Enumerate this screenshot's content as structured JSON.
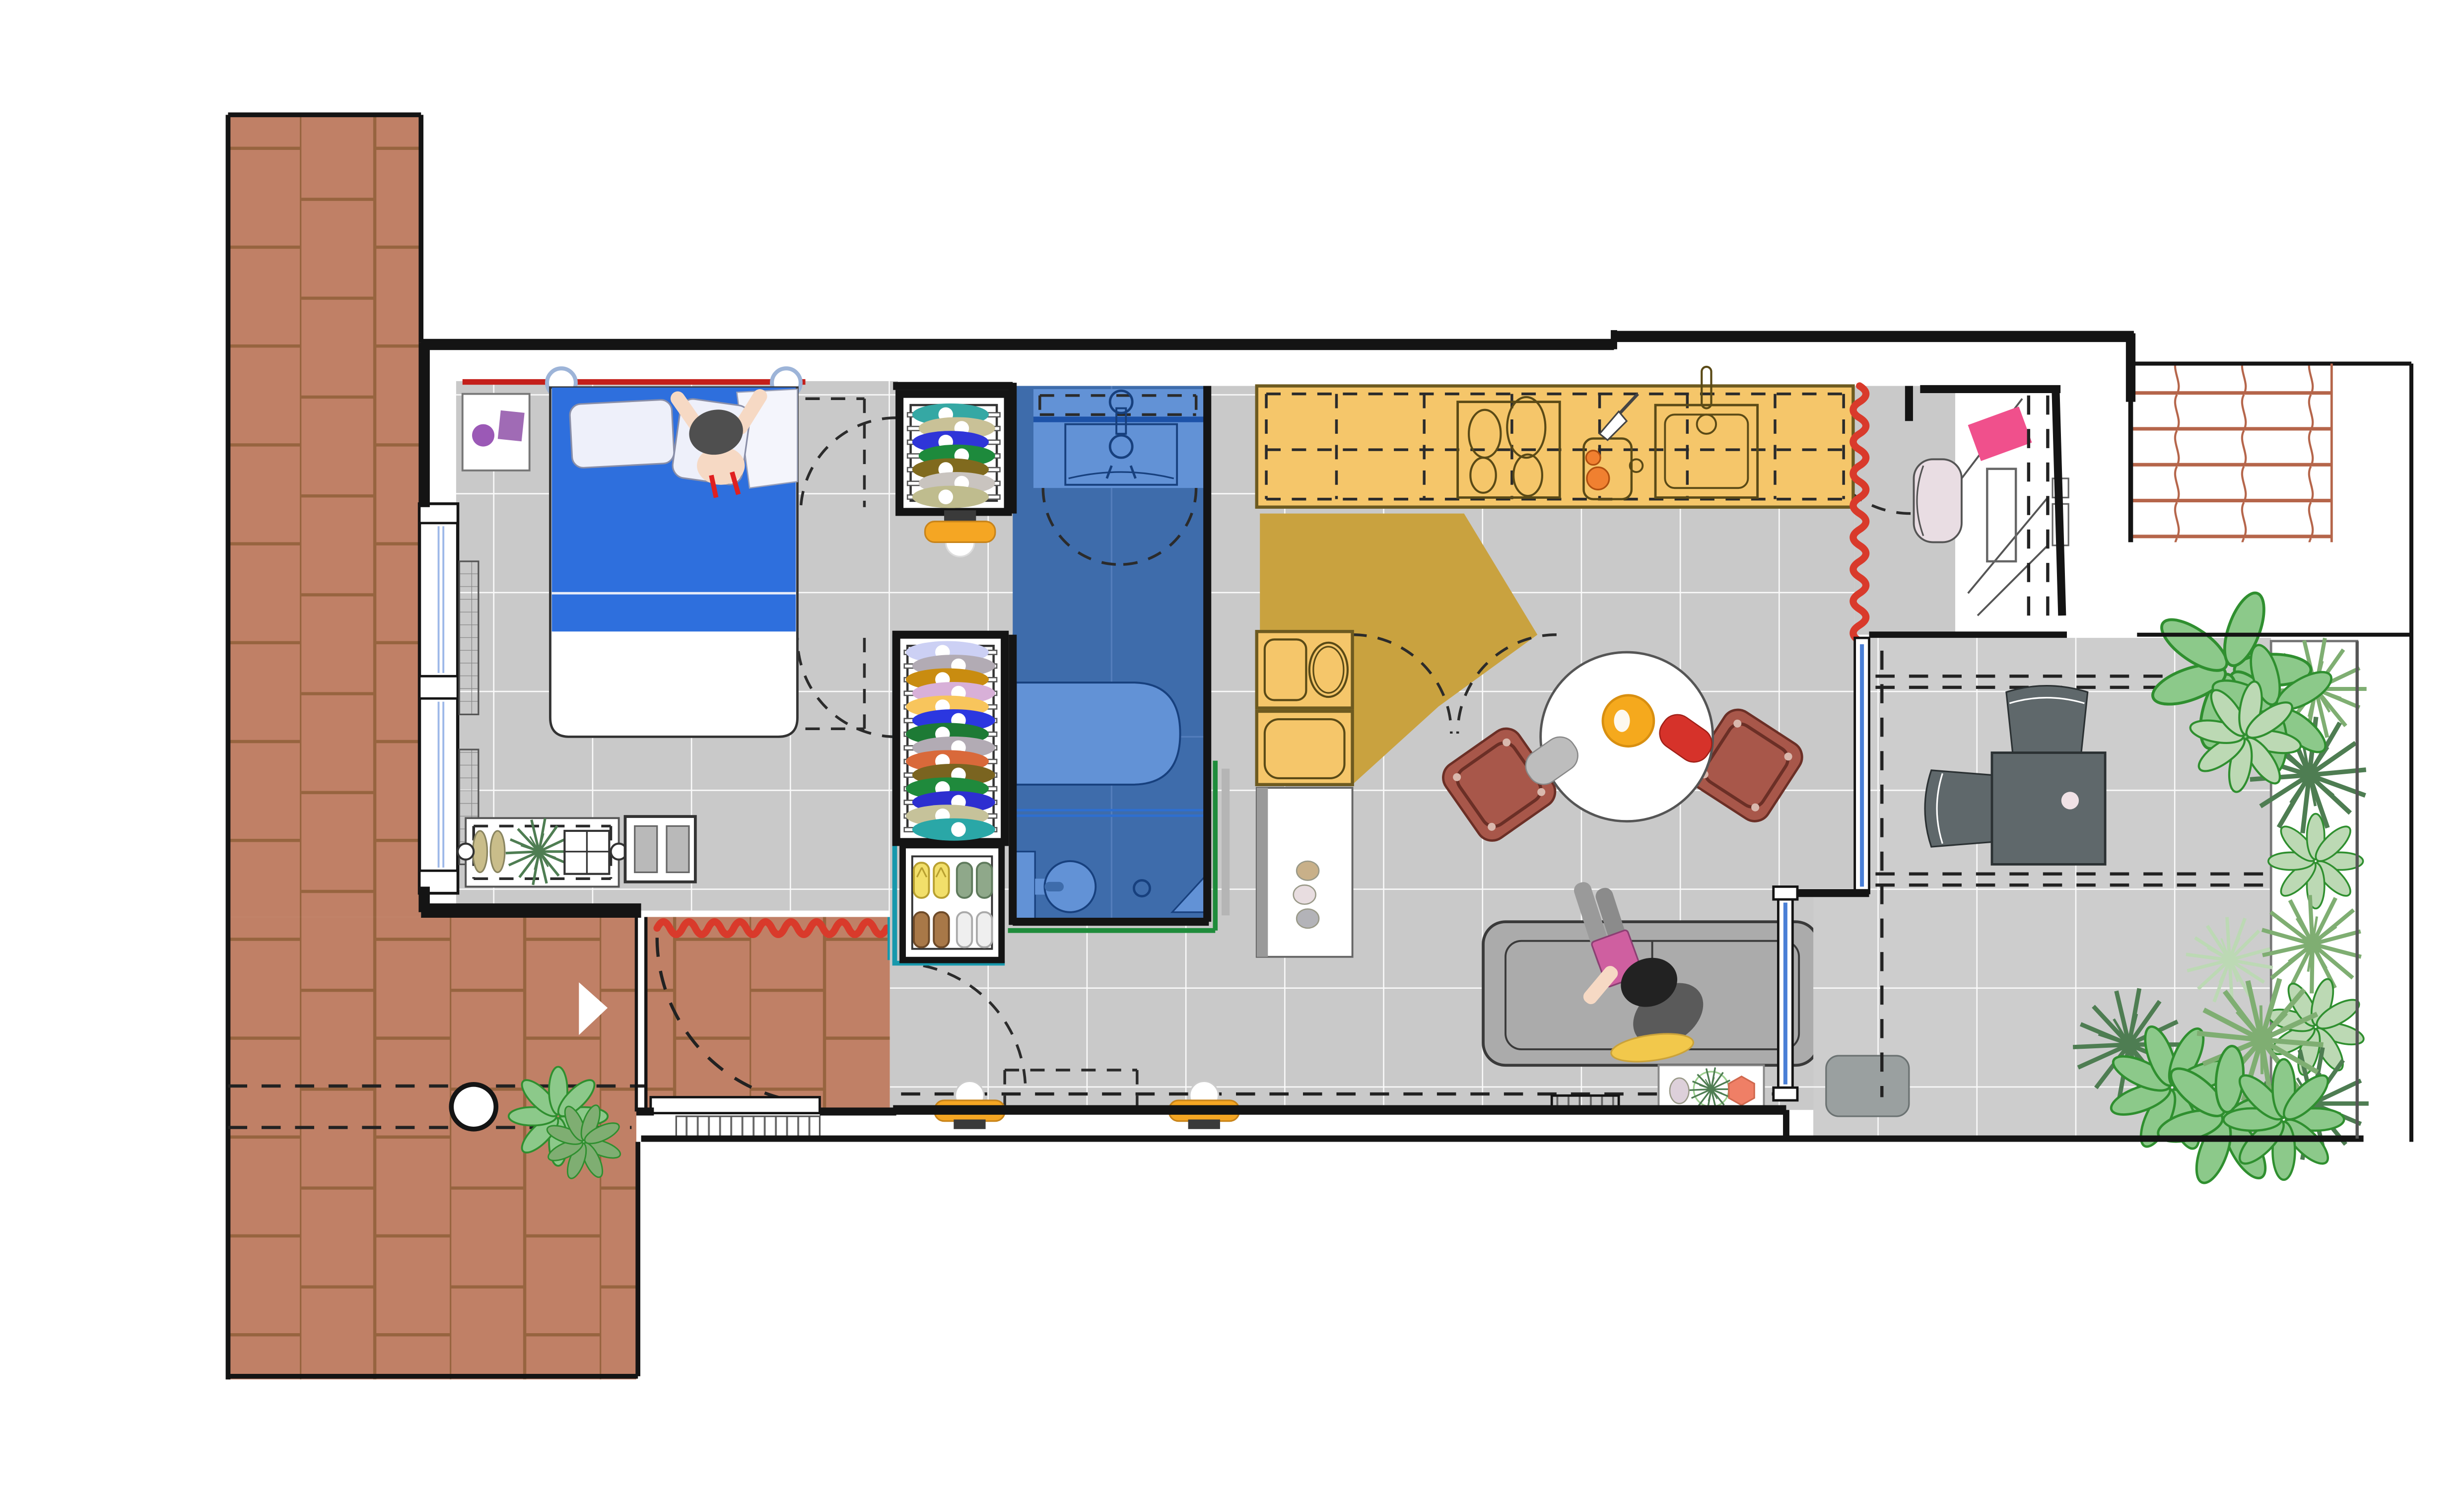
{
  "document": {
    "title": "Apartment floor plan - top view",
    "type": "architectural-drawing",
    "visible_text": []
  },
  "rooms": [
    {
      "id": "terrace",
      "label": "brick terrace (left)"
    },
    {
      "id": "entry-hall",
      "label": "entry hall with radiator and door mat"
    },
    {
      "id": "bedroom",
      "label": "bedroom with double bed"
    },
    {
      "id": "closets",
      "label": "wardrobe column: coat closet, wardrobe, shoe cabinet"
    },
    {
      "id": "bathroom",
      "label": "bathroom (blue floor)"
    },
    {
      "id": "kitchen",
      "label": "kitchen (yellow counters, mustard light wedge)"
    },
    {
      "id": "dining",
      "label": "dining area, round table, two chairs"
    },
    {
      "id": "living",
      "label": "living area with sofa and reading person"
    },
    {
      "id": "entry-nook",
      "label": "patio entry nook with door leaf and doormat"
    },
    {
      "id": "patio",
      "label": "outdoor patio with desk set and bench"
    },
    {
      "id": "planter",
      "label": "side planting bed with shrubs"
    },
    {
      "id": "pergola",
      "label": "terracotta pergola grid (top right)"
    }
  ],
  "colors": {
    "wall": "#141414",
    "floor": "#c9c9c9",
    "floor_line": "#ffffff",
    "patio": "#cdcdcd",
    "brick": "#c08066",
    "brick_line": "#97643f",
    "bath_floor": "#3e6cab",
    "bath_fixture": "#6292d6",
    "bath_line": "#17407e",
    "glass": "#4a7fd6",
    "counter": "#f5c66a",
    "counter_line": "#6d5a20",
    "sun": "#c9a23f",
    "zigzag": "#d93a2b",
    "wall_red": "#c41f1a",
    "teal": "#1798ac",
    "green": "#1f8c3b",
    "blanket": "#2e6fdd",
    "sheet": "#ffffff",
    "pillow": "#eef0fa",
    "skin": "#f6d9c4",
    "hair": "#4f4f4f",
    "strap": "#e02020",
    "sofa": "#ababab",
    "rug": "#f2c84b",
    "book": "#cf5fa0",
    "sweater": "#5a5a5a",
    "hair2": "#222222",
    "pants": "#9a9a9a",
    "legblanket": "#8b8b8b",
    "chair": "#a8574a",
    "chair_line": "#6b2f26",
    "mat_gray": "#bdbdbd",
    "mat_red": "#d6322a",
    "bowl": "#f5a91d",
    "table_white": "#ffffff",
    "desk": "#5f686b",
    "bench": "#9aa0a0",
    "leaf": "#8cc98a",
    "leaf_line": "#2f8f2f",
    "plant_dark": "#4e7d52",
    "plant_mid": "#7fae72",
    "plant_light": "#bcd9b4",
    "pergola": "#b5654a",
    "doormat": "#f0508c",
    "armchair": "#e9dde3",
    "lamp": "#f5a623",
    "lamp_base": "#3a3a3a",
    "purple": "#9b59b6",
    "island_strip": "#9a9a9a",
    "pebble1": "#c8b089",
    "pebble2": "#e8dde0",
    "pebble3": "#b3b3b8",
    "pebble_lav": "#ddd0da",
    "hex_coral": "#ef7f66",
    "tomato": "#f08030"
  },
  "closet_top": {
    "label": "coat closet clothes (hanging, top view)",
    "colors": [
      "#35a8a4",
      "#c9c197",
      "#2f35d8",
      "#1d8a3c",
      "#806a1e",
      "#c9c4bf",
      "#bfbc8e"
    ]
  },
  "wardrobe": {
    "label": "main wardrobe clothes (hanging, top view)",
    "colors": [
      "#ccd0f4",
      "#b2abb4",
      "#c98c10",
      "#d8b0d8",
      "#f8c55c",
      "#2b37e0",
      "#1d7a35",
      "#b2abb4",
      "#d9693a",
      "#7a6420",
      "#1f8a3c",
      "#2d2fd0",
      "#c6c29a",
      "#2aa7a7"
    ]
  },
  "shoe_cabinet": {
    "label": "shoe cabinet: 4 pairs",
    "pairs": [
      "#f2df6a",
      "#8fa88a",
      "#a87848",
      "#efefef"
    ],
    "pair_lines": [
      "#b8a030",
      "#5f7a5c",
      "#6e4a28",
      "#aaaaaa"
    ]
  }
}
